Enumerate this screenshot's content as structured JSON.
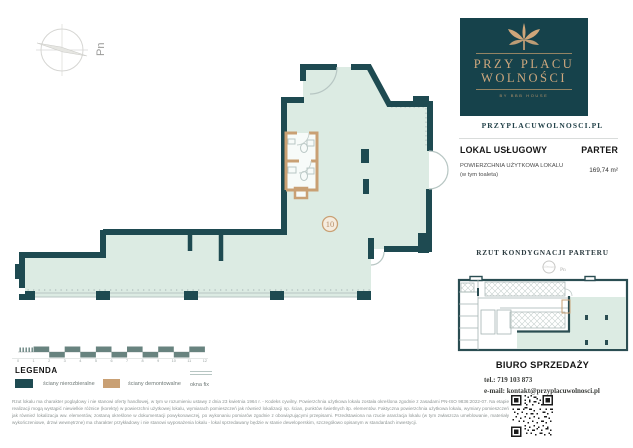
{
  "branding": {
    "logo_line1": "PRZY PLACU",
    "logo_line2": "WOLNOŚCI",
    "logo_tagline": "BY BBB HOUSE",
    "website": "PRZYPLACUWOLNOSCI.PL"
  },
  "unit": {
    "type": "LOKAL USŁUGOWY",
    "floor": "PARTER",
    "area_label": "POWIERZCHNIA UŻYTKOWA LOKALU",
    "area_note": "(w tym toaleta)",
    "area_value": "169,74 m²",
    "number": "10"
  },
  "overview": {
    "title": "RZUT KONDYGNACJI PARTERU",
    "north_label": "Pn"
  },
  "sales": {
    "title": "BIURO SPRZEDAŻY",
    "phone": "tel.: 719 103 873",
    "email": "e-mail: kontakt@przyplacuwolnosci.pl"
  },
  "compass": {
    "north_label": "Pn"
  },
  "scale_bar": {
    "unit": "m",
    "ticks": [
      "0",
      "1",
      "2",
      "3",
      "4",
      "5",
      "6",
      "7",
      "8",
      "9",
      "10",
      "11",
      "12"
    ]
  },
  "legend": {
    "title": "LEGENDA",
    "items": [
      {
        "label": "ściany nierozbieralne",
        "color": "#1e4a51"
      },
      {
        "label": "ściany demontowalne",
        "color": "#c9a074"
      },
      {
        "label": "okna fix",
        "color": "#b7c6c3"
      }
    ]
  },
  "disclaimer": "Rzut lokalu ma charakter poglądowy i nie stanowi oferty handlowej, w tym w rozumieniu ustawy z dnia 23 kwietnia 1964 r. - Kodeks cywilny. Powierzchnia użytkowa lokalu została określona zgodnie z zasadami PN-ISO 9836:2022-07. Na etapie realizacji mogą wystąpić niewielkie różnice (korekty) w powierzchni użytkowej lokalu, wymiarach pomieszczeń jak również lokalizacji np. ścian, punktów świetlnych itp. elementów. Faktyczna powierzchnia użytkowa lokalu, wymiary pomieszczeń jak również lokalizacja ww. elementów, zostaną określone w dokumentacji powykonawczej, po wykonaniu pomiarów zgodnie z obowiązującymi przepisami. Przedstawiona na rzucie aranżacja lokalu (w tym zwłaszcza umeblowanie, materiały wykończeniowe, drzwi wewnętrzne) ma charakter przykładowy i nie stanowi wyposażenia lokalu - lokal sprzedawany będzie w stanie deweloperskim, szczegółowo opisanym w standardach inwestycji.",
  "icons": {
    "logo_mark": "lotus-leaf-icon",
    "compass": "compass-rose-icon",
    "qr": "qr-code"
  },
  "colors": {
    "brand_dark": "#16424b",
    "brand_tan": "#c9a074",
    "wall": "#1e4a51",
    "floor_fill": "#dcebe3"
  }
}
